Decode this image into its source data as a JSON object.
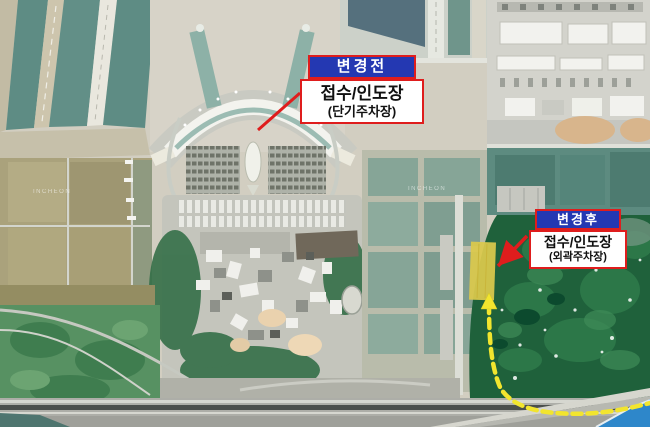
{
  "map": {
    "ground_labels": [
      {
        "text": "INCHEON"
      },
      {
        "text": "INCHEON"
      }
    ]
  },
  "callouts": {
    "before": {
      "title": "변경전",
      "line1": "접수/인도장",
      "line2": "(단기주차장)"
    },
    "after": {
      "title": "변경후",
      "line1": "접수/인도장",
      "line2": "(외곽주차장)"
    }
  },
  "colors": {
    "callout_border_red": "#df1d1d",
    "callout_header_blue": "#2438b2",
    "callout_header_text": "#ffffff",
    "callout_body_text": "#111111",
    "leader_line_red": "#df1d1d",
    "highlight_parking_yellow": "#dcc94c",
    "route_dashed_yellow": "#f2e52e",
    "sea_blue": "#2e87ca",
    "golf_green": "#1f613b"
  }
}
